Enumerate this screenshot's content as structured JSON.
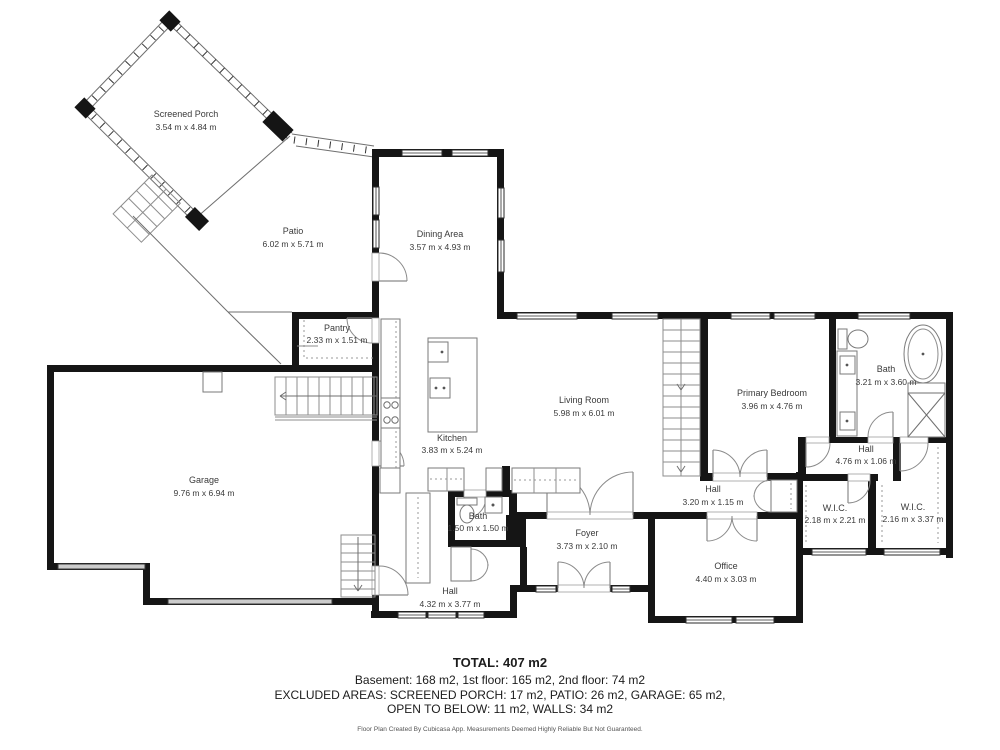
{
  "title": "Floor plan",
  "rooms": [
    {
      "name": "Screened Porch",
      "dims": "3.54 m x 4.84 m"
    },
    {
      "name": "Patio",
      "dims": "6.02 m x 5.71 m"
    },
    {
      "name": "Dining Area",
      "dims": "3.57 m x 4.93 m"
    },
    {
      "name": "Pantry",
      "dims": "2.33 m x 1.51 m"
    },
    {
      "name": "Kitchen",
      "dims": "3.83 m x 5.24 m"
    },
    {
      "name": "Living Room",
      "dims": "5.98 m x 6.01 m"
    },
    {
      "name": "Primary Bedroom",
      "dims": "3.96 m x 4.76 m"
    },
    {
      "name": "Bath",
      "dims": "3.21 m x 3.60 m"
    },
    {
      "name": "Hall",
      "dims": "4.76 m x 1.06 m"
    },
    {
      "name": "Garage",
      "dims": "9.76 m x 6.94 m"
    },
    {
      "name": "Hall",
      "dims": "3.20 m x 1.15 m"
    },
    {
      "name": "W.I.C.",
      "dims": "2.18 m x 2.21 m"
    },
    {
      "name": "W.I.C.",
      "dims": "2.16 m x 3.37 m"
    },
    {
      "name": "Bath",
      "dims": "1.50 m x 1.50 m"
    },
    {
      "name": "Foyer",
      "dims": "3.73 m x 2.10 m"
    },
    {
      "name": "Office",
      "dims": "4.40 m x 3.03 m"
    },
    {
      "name": "Hall",
      "dims": "4.32 m x 3.77 m"
    }
  ],
  "summary": {
    "total": "TOTAL: 407 m2",
    "floors": "Basement: 168 m2, 1st floor: 165 m2, 2nd floor: 74 m2",
    "excluded1": "EXCLUDED AREAS: SCREENED PORCH: 17 m2, PATIO: 26 m2, GARAGE: 65 m2,",
    "excluded2": "OPEN TO BELOW: 11 m2, WALLS: 34 m2",
    "disclaimer": "Floor Plan Created By Cubicasa App. Measurements Deemed Highly Reliable But Not Guaranteed."
  },
  "colors": {
    "wall": "#151515",
    "label": "#3a3a3a",
    "garage_door": "#cccccc"
  }
}
